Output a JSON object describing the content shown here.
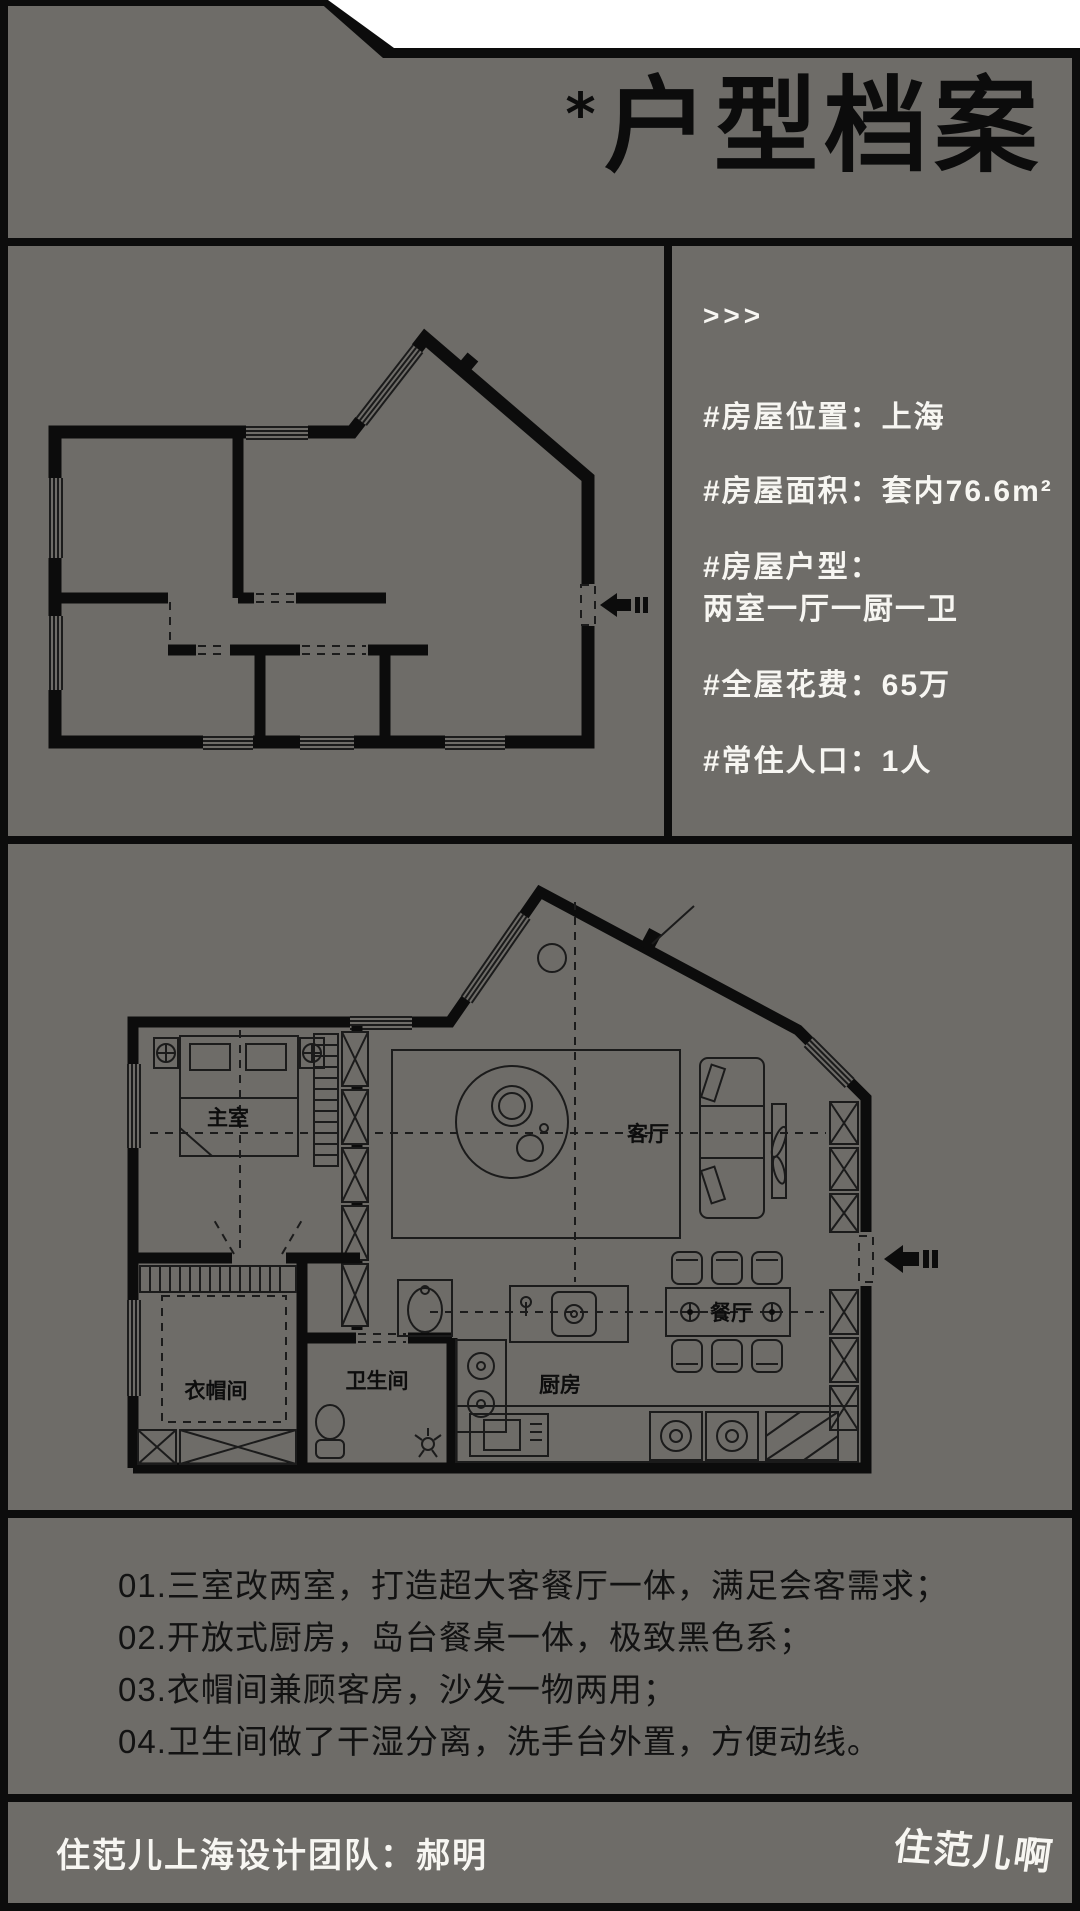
{
  "colors": {
    "background": "#6E6C68",
    "ink": "#0C0C0C",
    "text_light": "#F7F6F2"
  },
  "header": {
    "title_prefix": "*",
    "title": "户型档案"
  },
  "info_panel": {
    "chevrons": ">>>",
    "items": [
      "#房屋位置：上海",
      "#房屋面积：套内76.6m²",
      "#房屋户型：",
      "两室一厅一厨一卫",
      "#全屋花费：65万",
      "#常住人口：1人"
    ]
  },
  "plans": {
    "rooms": [
      {
        "label": "主室"
      },
      {
        "label": "客厅"
      },
      {
        "label": "衣帽间"
      },
      {
        "label": "卫生间"
      },
      {
        "label": "厨房"
      },
      {
        "label": "餐厅"
      }
    ]
  },
  "highlights": [
    "01.三室改两室，打造超大客餐厅一体，满足会客需求；",
    "02.开放式厨房，岛台餐桌一体，极致黑色系；",
    "03.衣帽间兼顾客房，沙发一物两用；",
    "04.卫生间做了干湿分离，洗手台外置，方便动线。"
  ],
  "footer": {
    "team": "住范儿上海设计团队：郝明",
    "watermark": "住范儿啊"
  }
}
